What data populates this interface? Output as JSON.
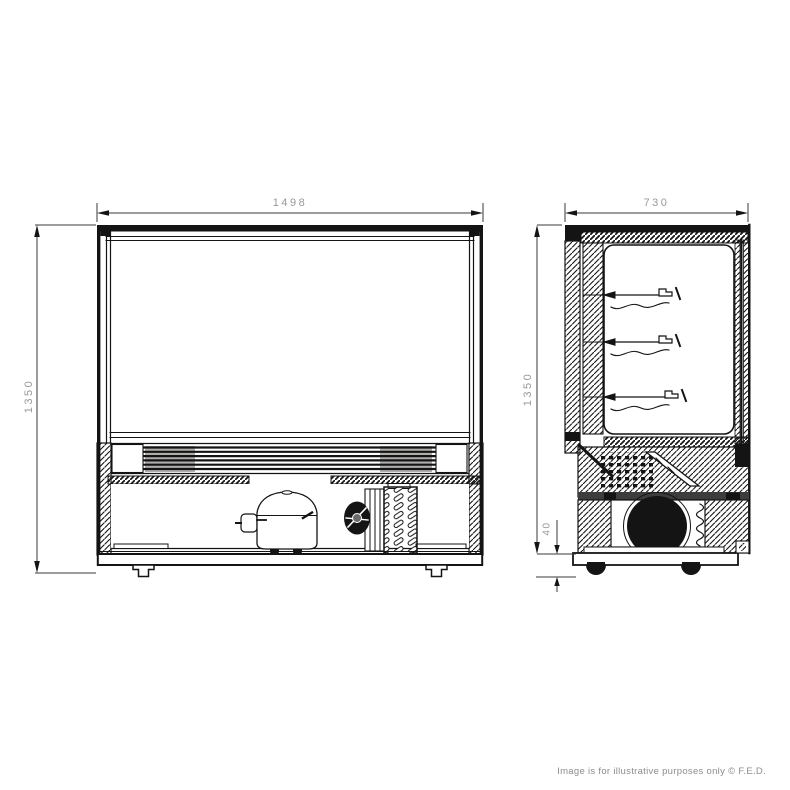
{
  "diagram": {
    "front_view": {
      "width_label": "1498",
      "height_label": "1350"
    },
    "side_view": {
      "depth_label": "730",
      "height_label": "1350",
      "base_height_label": "40"
    },
    "watermark": "Image is for illustrative purposes only © F.E.D.",
    "colors": {
      "line": "#141414",
      "dim_text": "#97989a",
      "watermark_text": "#8d8d8d",
      "vent_shade": "#b0adad",
      "duct_band": "#3d3d3d"
    }
  }
}
